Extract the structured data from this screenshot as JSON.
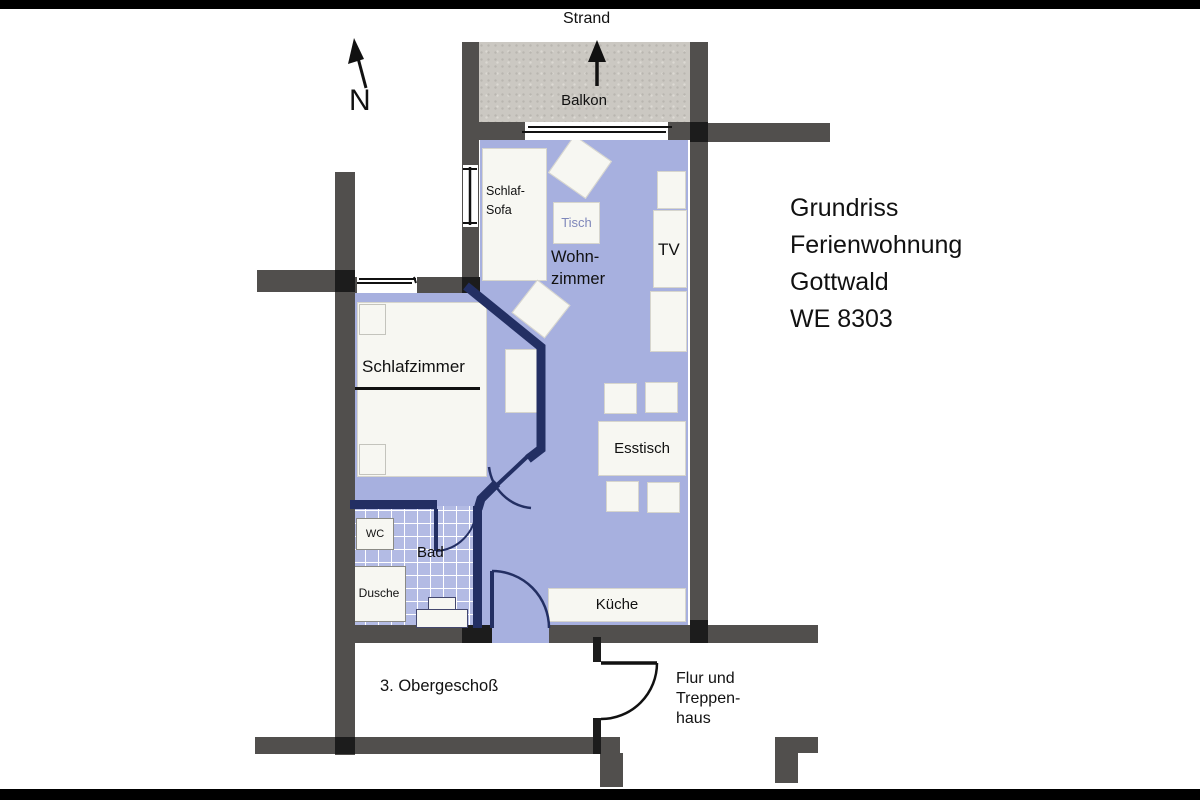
{
  "title_block": {
    "lines": [
      "Grundriss",
      "Ferienwohnung",
      "Gottwald",
      "WE 8303"
    ]
  },
  "compass": {
    "label": "N"
  },
  "orientation": {
    "beach_label": "Strand"
  },
  "floor_info": {
    "level_label": "3. Obergeschoß",
    "stairwell_lines": [
      "Flur und",
      "Treppen-",
      "haus"
    ]
  },
  "rooms": {
    "balcony_label": "Balkon",
    "living_line1": "Wohn-",
    "living_line2": "zimmer",
    "bedroom_label": "Schlafzimmer",
    "bath_label": "Bad",
    "kitchen_label": "Küche"
  },
  "furniture": {
    "sofa_line1": "Schlaf-",
    "sofa_line2": "Sofa",
    "table_label": "Tisch",
    "tv_label": "TV",
    "dining_label": "Esstisch",
    "wc_label": "WC",
    "shower_label": "Dusche"
  },
  "colors": {
    "floor_blue": "#a7b0df",
    "tile_blue": "#b3bbe4",
    "wall_gray": "#514f4d",
    "joint_black": "#1c1c1c",
    "partition_navy": "#232f63",
    "balcony_gray": "#cbc8c2",
    "furniture_white": "#f7f7f2",
    "table_text_blue": "#7e87ba",
    "text_black": "#111111"
  }
}
